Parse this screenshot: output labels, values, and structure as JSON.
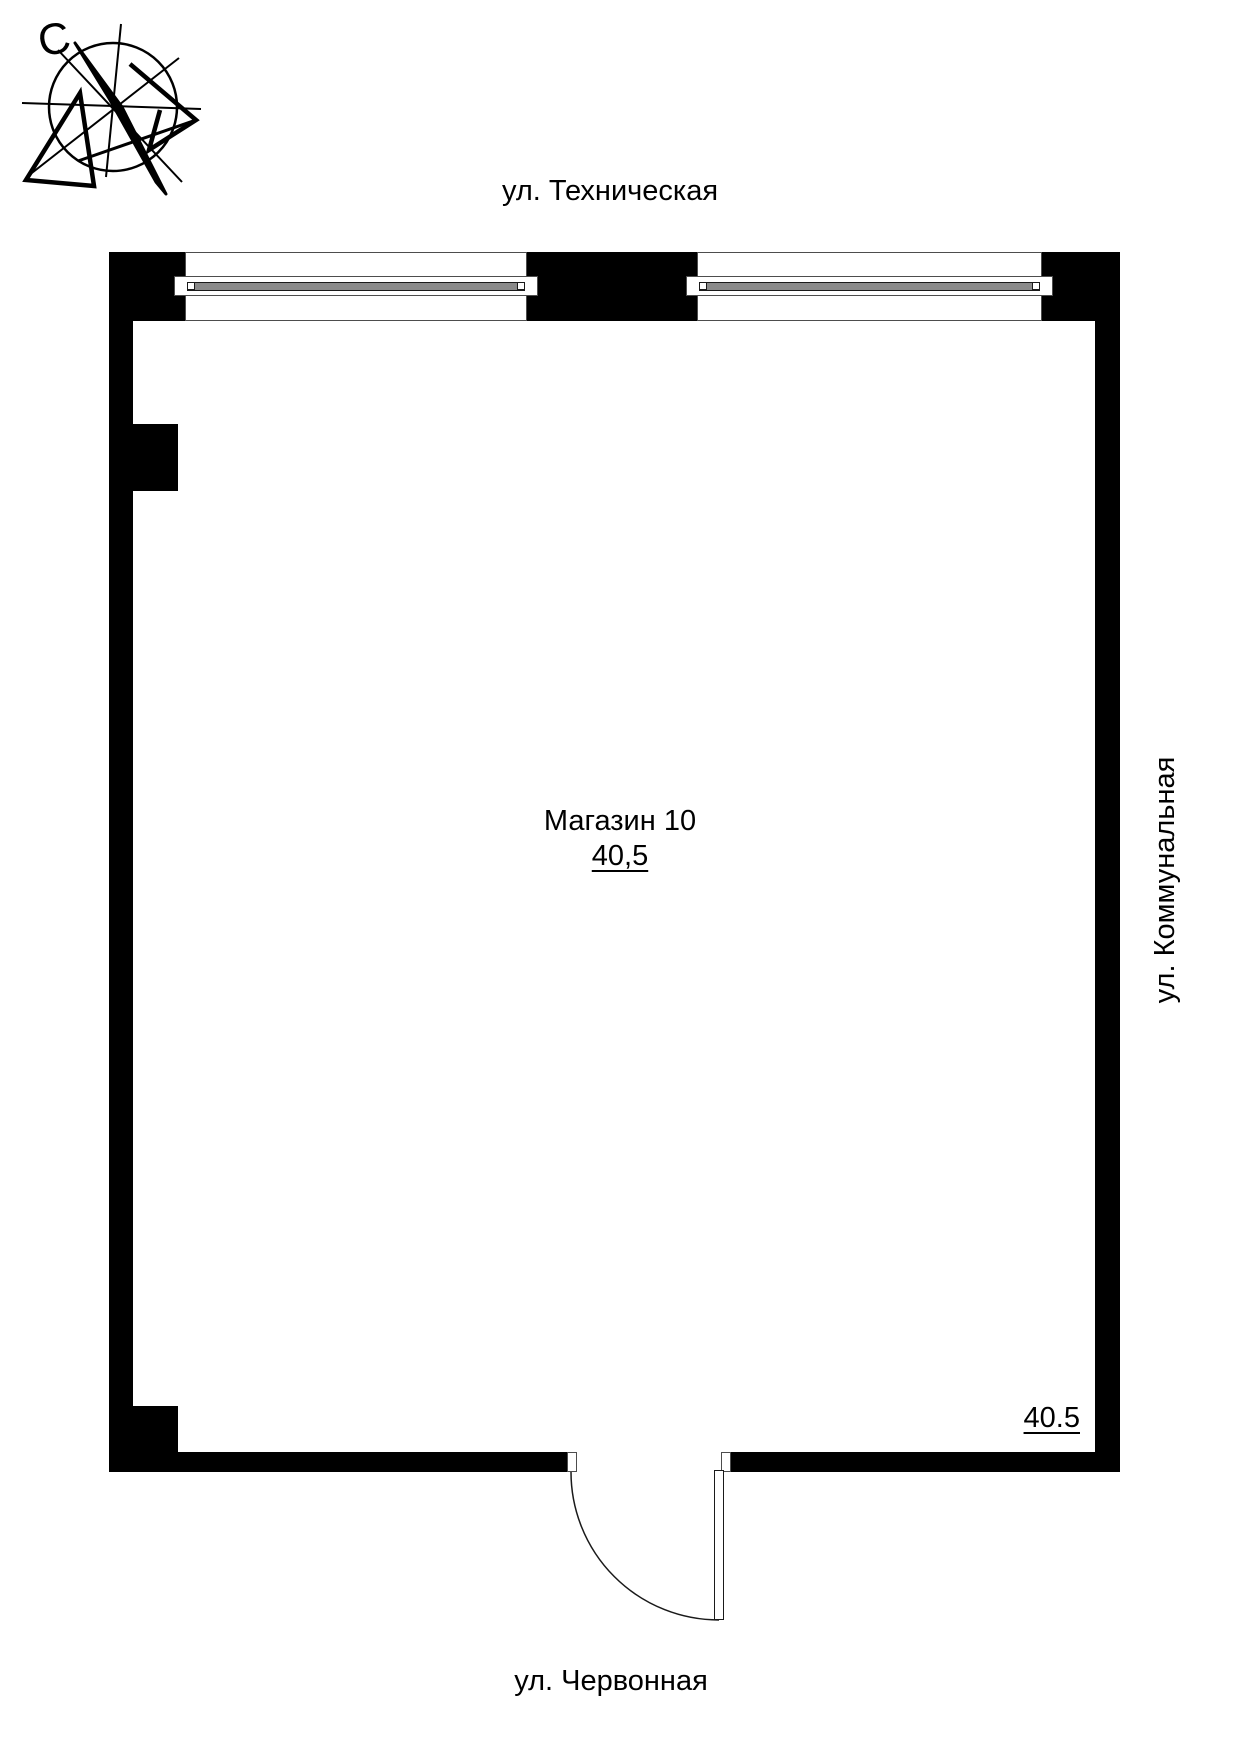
{
  "document_title": "План помещения — Магазин 10",
  "compass": {
    "north_label": "С"
  },
  "streets": {
    "top": "ул. Техническая",
    "right": "ул. Коммунальная",
    "bottom": "ул. Червонная"
  },
  "room": {
    "name": "Магазин 10",
    "area": "40,5"
  },
  "dimension_note": "40.5",
  "colors": {
    "wall": "#000000",
    "background": "#ffffff",
    "outline": "#4d4d4d",
    "glazing": "#8a8a8a"
  }
}
